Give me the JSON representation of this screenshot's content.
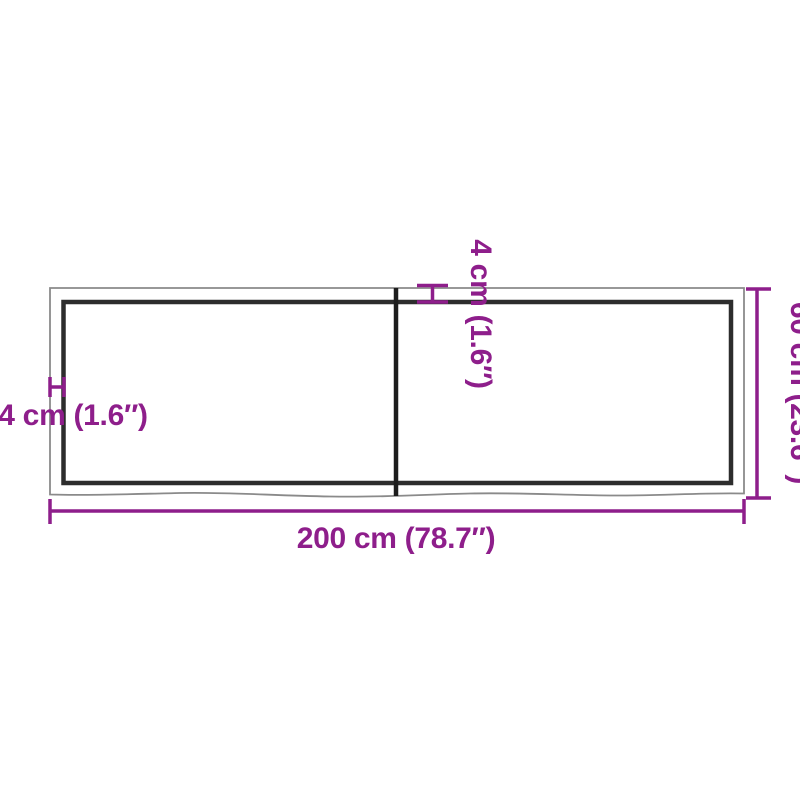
{
  "labels": {
    "width": "200 cm (78.7″)",
    "depth": "60 cm (23.6″)",
    "thickness_side": "4 cm (1.6″)",
    "thickness_top": "4 cm (1.6″)"
  },
  "colors": {
    "dimension": "#8e1e8b",
    "outer_edge": "#8a8a8a",
    "inner_edge": "#2d2d2d",
    "divider": "#1d1d1d",
    "background": "#ffffff"
  }
}
